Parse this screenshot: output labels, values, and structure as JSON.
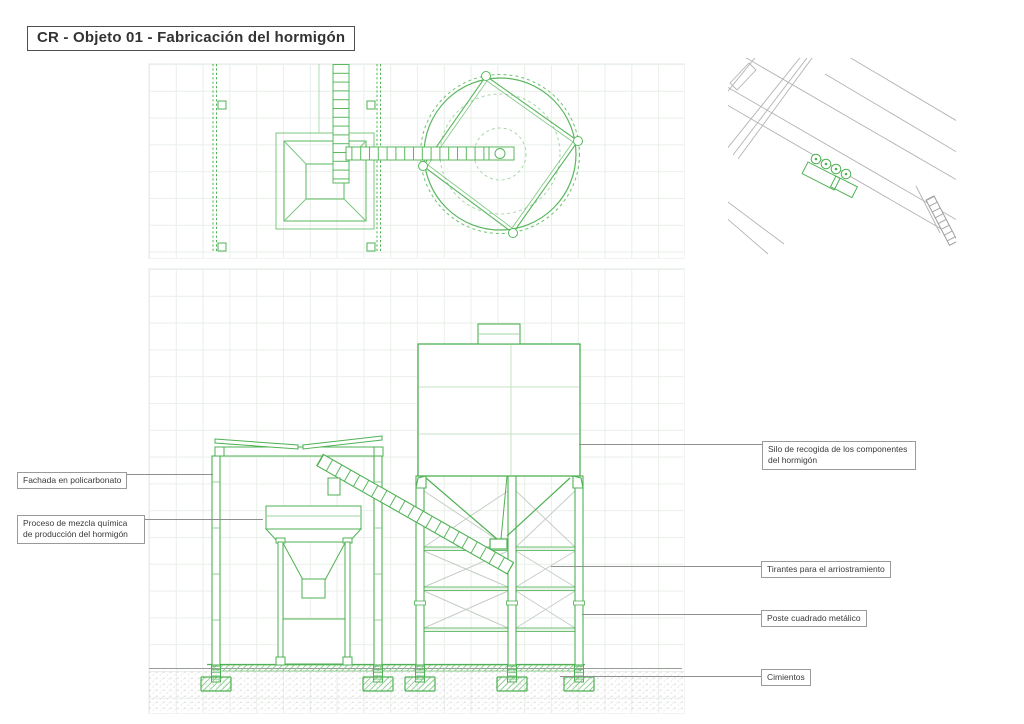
{
  "title": "CR - Objeto 01 - Fabricación del hormigón",
  "annotations": {
    "fachada": "Fachada en policarbonato",
    "proceso": "Proceso de mezcla química de producción del hormigón",
    "silo": "Silo de recogida de los componentes del hormigón",
    "tirantes": "Tirantes para el arriostramiento",
    "poste": "Poste cuadrado metálico",
    "cimientos": "Cimientos"
  },
  "colors": {
    "drawing_green": "#4eb153",
    "light_green": "#9fd4a0",
    "extra_light_green": "#c6e3c6",
    "brace_gray": "#c6cec6",
    "leader_gray": "#8f8f8f",
    "map_gray": "#b3b3b3",
    "text_dark": "#3a3a3a",
    "grid": "#e9efe9"
  }
}
